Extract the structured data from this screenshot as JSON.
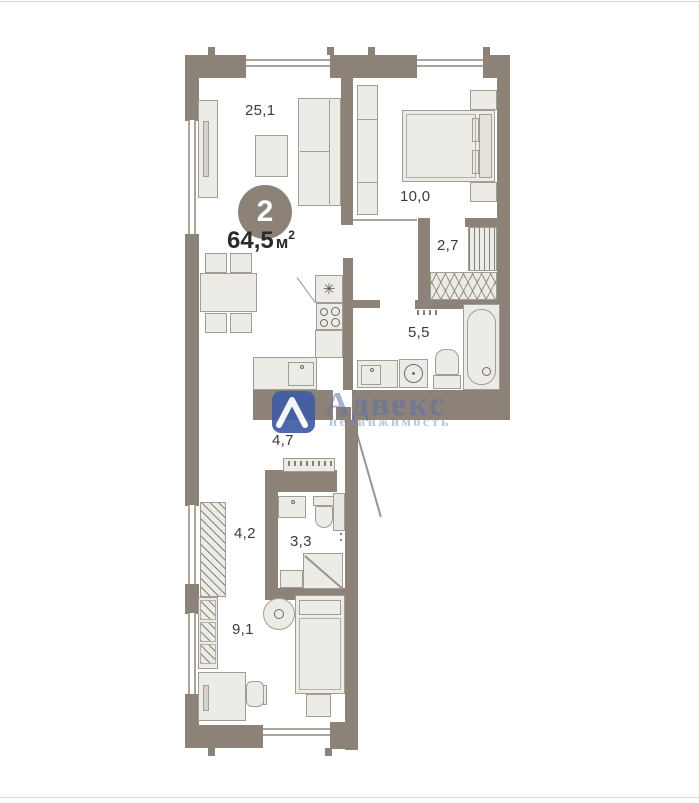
{
  "plan": {
    "badge_number": "2",
    "total_area": {
      "value": "64,5",
      "unit": "м",
      "sup": "2"
    },
    "rooms": {
      "living": {
        "area": "25,1"
      },
      "bedroom": {
        "area": "10,0"
      },
      "closet": {
        "area": "2,7"
      },
      "bath_main": {
        "area": "5,5"
      },
      "hall": {
        "area": "4,7"
      },
      "corridor": {
        "area": "4,2"
      },
      "bath_small": {
        "area": "3,3"
      },
      "small_room": {
        "area": "9,1"
      }
    }
  },
  "watermark": {
    "brand": "Адвекс",
    "tagline": "недвижимость"
  },
  "icons": {
    "fridge": "✳"
  },
  "colors": {
    "wall": "#8c8278",
    "furniture_fill": "#edebe5",
    "furniture_border": "#a29d94",
    "label_text": "#3c3b39",
    "badge_bg": "#8c8278",
    "watermark_blue": "#3e5ea7"
  }
}
